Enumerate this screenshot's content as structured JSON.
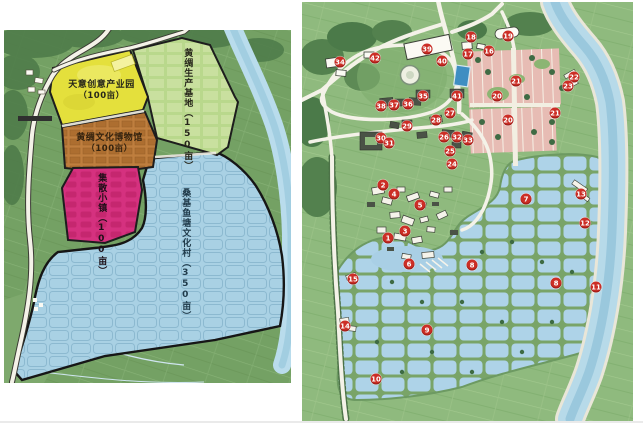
{
  "page": {
    "background": "#ffffff"
  },
  "left_map": {
    "zones": [
      {
        "label": "天意创意产业园",
        "area": "（100亩）",
        "color": "#e4e03c"
      },
      {
        "label": "黄绸生产基地（150亩）",
        "area": "",
        "color": "#b9d88c"
      },
      {
        "label": "黄绸文化博物馆",
        "area": "（100亩）",
        "color": "#bf7e3e"
      },
      {
        "label": "集散小镇（100亩）",
        "area": "",
        "color": "#d5317f"
      },
      {
        "label": "桑基鱼塘文化村（350亩）",
        "area": "",
        "color": "#a9d1e4"
      }
    ],
    "river_color": "#b9dcec",
    "farmland_color": "#74a164"
  },
  "right_map": {
    "marker_color": "#cc2e26",
    "pond_color": "#aed3e8",
    "field_color": "#e7bcb4",
    "markers": [
      {
        "n": "1",
        "x": 86,
        "y": 236
      },
      {
        "n": "2",
        "x": 81,
        "y": 183
      },
      {
        "n": "3",
        "x": 103,
        "y": 229
      },
      {
        "n": "4",
        "x": 92,
        "y": 192
      },
      {
        "n": "5",
        "x": 118,
        "y": 203
      },
      {
        "n": "6",
        "x": 107,
        "y": 262
      },
      {
        "n": "7",
        "x": 224,
        "y": 197
      },
      {
        "n": "8",
        "x": 170,
        "y": 263
      },
      {
        "n": "8",
        "x": 254,
        "y": 281
      },
      {
        "n": "9",
        "x": 125,
        "y": 328
      },
      {
        "n": "10",
        "x": 74,
        "y": 377
      },
      {
        "n": "11",
        "x": 294,
        "y": 285
      },
      {
        "n": "12",
        "x": 283,
        "y": 221
      },
      {
        "n": "13",
        "x": 279,
        "y": 192
      },
      {
        "n": "14",
        "x": 43,
        "y": 324
      },
      {
        "n": "15",
        "x": 51,
        "y": 277
      },
      {
        "n": "16",
        "x": 187,
        "y": 49
      },
      {
        "n": "17",
        "x": 166,
        "y": 52
      },
      {
        "n": "18",
        "x": 169,
        "y": 35
      },
      {
        "n": "19",
        "x": 206,
        "y": 34
      },
      {
        "n": "20",
        "x": 195,
        "y": 94
      },
      {
        "n": "20",
        "x": 206,
        "y": 118
      },
      {
        "n": "21",
        "x": 214,
        "y": 79
      },
      {
        "n": "21",
        "x": 253,
        "y": 111
      },
      {
        "n": "22",
        "x": 272,
        "y": 75
      },
      {
        "n": "23",
        "x": 266,
        "y": 84
      },
      {
        "n": "24",
        "x": 150,
        "y": 162
      },
      {
        "n": "25",
        "x": 148,
        "y": 149
      },
      {
        "n": "26",
        "x": 142,
        "y": 135
      },
      {
        "n": "27",
        "x": 148,
        "y": 111
      },
      {
        "n": "28",
        "x": 134,
        "y": 118
      },
      {
        "n": "29",
        "x": 105,
        "y": 124
      },
      {
        "n": "30",
        "x": 79,
        "y": 136
      },
      {
        "n": "31",
        "x": 87,
        "y": 141
      },
      {
        "n": "32",
        "x": 155,
        "y": 135
      },
      {
        "n": "33",
        "x": 166,
        "y": 138
      },
      {
        "n": "34",
        "x": 38,
        "y": 60
      },
      {
        "n": "35",
        "x": 121,
        "y": 94
      },
      {
        "n": "36",
        "x": 106,
        "y": 102
      },
      {
        "n": "37",
        "x": 92,
        "y": 103
      },
      {
        "n": "38",
        "x": 79,
        "y": 104
      },
      {
        "n": "39",
        "x": 125,
        "y": 47
      },
      {
        "n": "40",
        "x": 140,
        "y": 59
      },
      {
        "n": "41",
        "x": 155,
        "y": 94
      },
      {
        "n": "42",
        "x": 73,
        "y": 56
      }
    ]
  }
}
